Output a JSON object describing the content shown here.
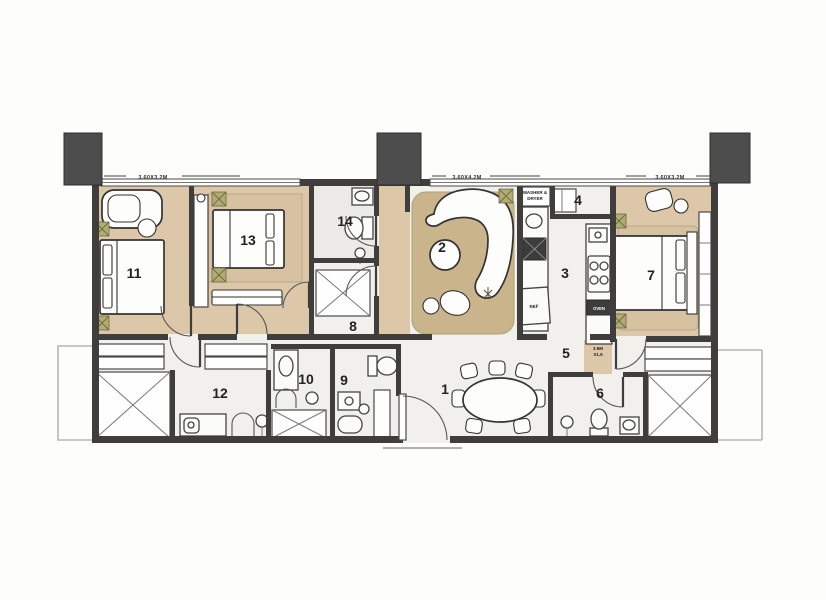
{
  "rooms": {
    "r1": {
      "number": "1"
    },
    "r2": {
      "number": "2"
    },
    "r3": {
      "number": "3"
    },
    "r4": {
      "number": "4"
    },
    "r5": {
      "number": "5"
    },
    "r6": {
      "number": "6"
    },
    "r7": {
      "number": "7"
    },
    "r8": {
      "number": "8"
    },
    "r9": {
      "number": "9"
    },
    "r10": {
      "number": "10"
    },
    "r11": {
      "number": "11"
    },
    "r12": {
      "number": "12"
    },
    "r13": {
      "number": "13"
    },
    "r14": {
      "number": "14"
    }
  },
  "annotations": {
    "dim_top_left": "3.60X3.2M",
    "dim_top_middle": "3.60X4.2M",
    "dim_top_right": "3.60X3.2M",
    "laundry_line1": "WASHER &",
    "laundry_line2": "DRYER",
    "fridge": "REF",
    "oven": "OVEN",
    "corridor_dim_line1": "3.9M",
    "corridor_dim_line2": "X1.5"
  },
  "colors": {
    "wall": "#3f3e3c",
    "column": "#4d4d4d",
    "wood_floor": "#dcc7a8",
    "rug_living": "#c9b48c",
    "rug_bedroom": "#d6c2a0",
    "plant": "#b2ac72",
    "floor": "#f1f0ec"
  }
}
